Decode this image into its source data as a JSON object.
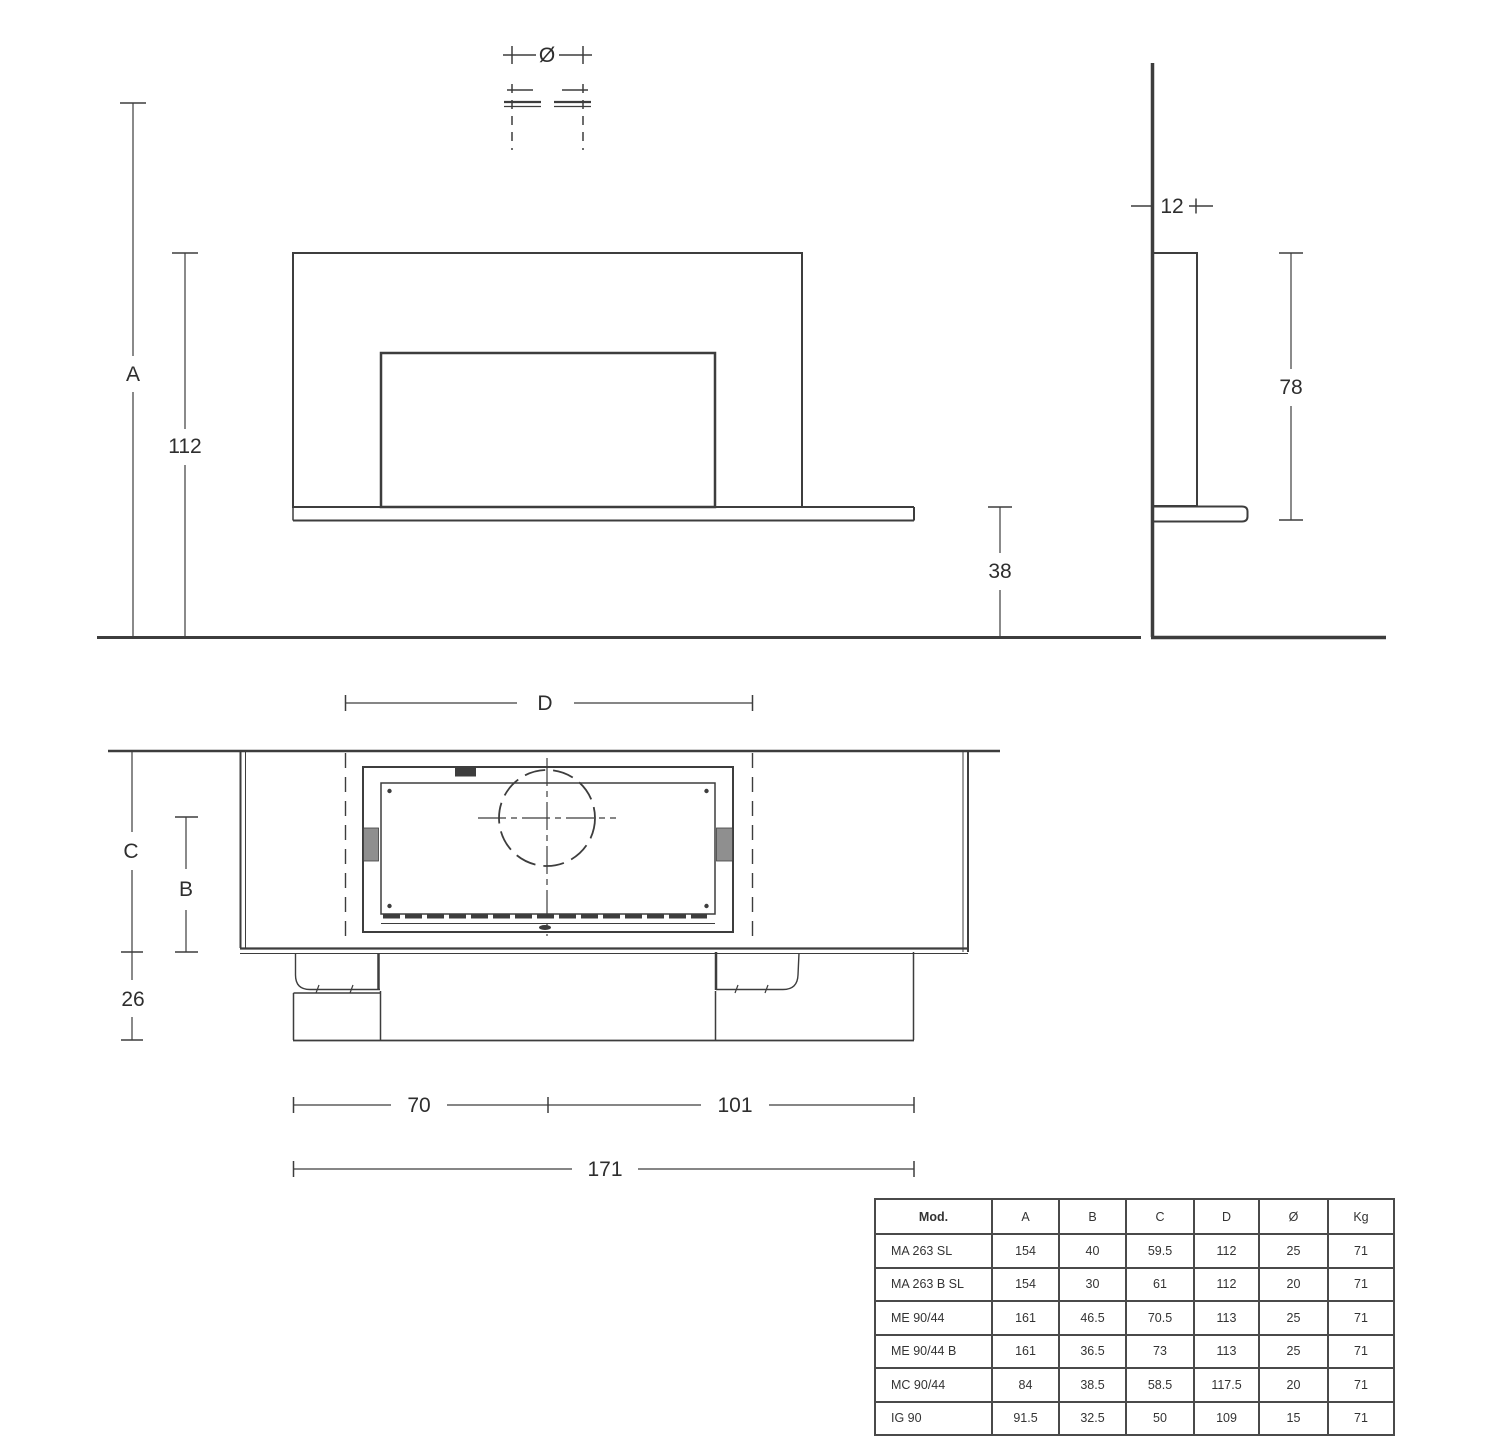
{
  "labels": {
    "diameter": "Ø",
    "a": "A",
    "h112": "112",
    "h38": "38",
    "t12": "12",
    "h78": "78",
    "c": "C",
    "b": "B",
    "d": "D",
    "n26": "26",
    "n70": "70",
    "n101": "101",
    "n171": "171"
  },
  "table": {
    "headers": [
      "Mod.",
      "A",
      "B",
      "C",
      "D",
      "Ø",
      "Kg"
    ],
    "rows": [
      [
        "MA 263 SL",
        "154",
        "40",
        "59.5",
        "112",
        "25",
        "71"
      ],
      [
        "MA 263 B SL",
        "154",
        "30",
        "61",
        "112",
        "20",
        "71"
      ],
      [
        "ME 90/44",
        "161",
        "46.5",
        "70.5",
        "113",
        "25",
        "71"
      ],
      [
        "ME 90/44 B",
        "161",
        "36.5",
        "73",
        "113",
        "25",
        "71"
      ],
      [
        "MC 90/44",
        "84",
        "38.5",
        "58.5",
        "117.5",
        "20",
        "71"
      ],
      [
        "IG 90",
        "91.5",
        "32.5",
        "50",
        "109",
        "15",
        "71"
      ]
    ]
  },
  "colors": {
    "line": "#3d3d3d",
    "text": "#2e2e2e",
    "table_border": "#4a4a4a",
    "gray_block": "#8f8f8f",
    "bg": "#ffffff"
  }
}
